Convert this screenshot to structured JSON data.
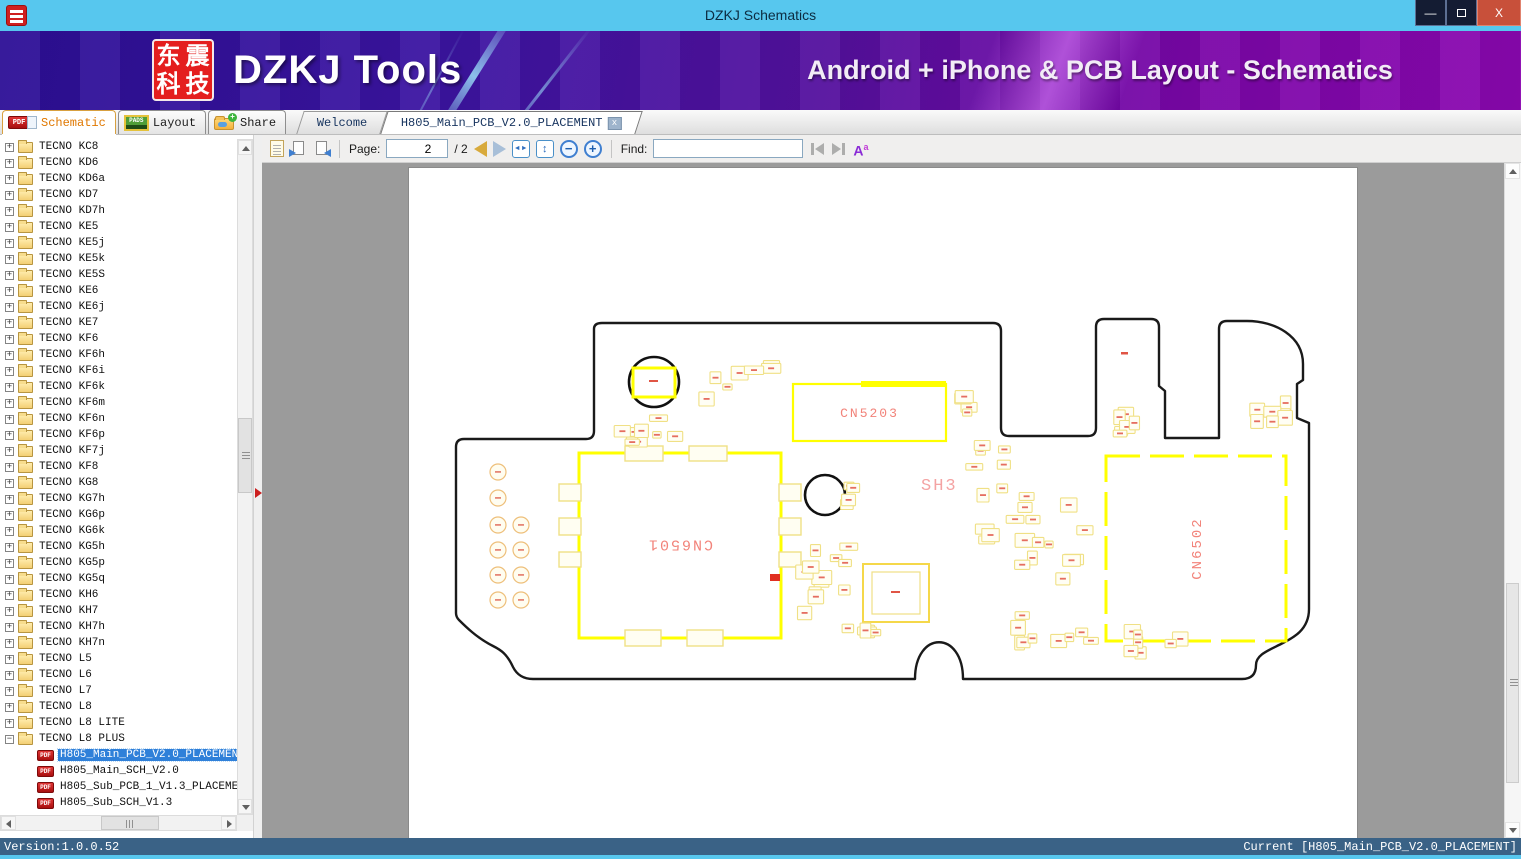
{
  "window": {
    "title": "DZKJ Schematics",
    "minimize_glyph": "—",
    "close_glyph": "X"
  },
  "banner": {
    "logo_chars": [
      "东",
      "震",
      "科",
      "技"
    ],
    "brand": "DZKJ Tools",
    "tagline": "Android + iPhone & PCB Layout - Schematics"
  },
  "app_tabs": [
    {
      "label": "Schematic",
      "icon": "pdf-icon",
      "active": true
    },
    {
      "label": "Layout",
      "icon": "pads-icon",
      "active": false
    },
    {
      "label": "Share",
      "icon": "share-folder-icon",
      "active": false
    }
  ],
  "doc_tabs": [
    {
      "label": "Welcome",
      "active": false,
      "closable": false
    },
    {
      "label": "H805_Main_PCB_V2.0_PLACEMENT",
      "active": true,
      "closable": true,
      "close_glyph": "x"
    }
  ],
  "pdf_badge_text": "PDF",
  "pads_badge_text": "PADS",
  "viewer_toolbar": {
    "page_label": "Page:",
    "page_current": "2",
    "page_total_text": "/ 2",
    "zoom_out_glyph": "−",
    "zoom_in_glyph": "+",
    "fit_width_glyph": "◄►",
    "fit_page_glyph": "↕",
    "find_label": "Find:",
    "find_value": "",
    "match_case_glyph": "A",
    "match_case_sup": "a"
  },
  "sidebar": {
    "folders": [
      "TECNO KC8",
      "TECNO KD6",
      "TECNO KD6a",
      "TECNO KD7",
      "TECNO KD7h",
      "TECNO KE5",
      "TECNO KE5j",
      "TECNO KE5k",
      "TECNO KE5S",
      "TECNO KE6",
      "TECNO KE6j",
      "TECNO KE7",
      "TECNO KF6",
      "TECNO KF6h",
      "TECNO KF6i",
      "TECNO KF6k",
      "TECNO KF6m",
      "TECNO KF6n",
      "TECNO KF6p",
      "TECNO KF7j",
      "TECNO KF8",
      "TECNO KG8",
      "TECNO KG7h",
      "TECNO KG6p",
      "TECNO KG6k",
      "TECNO KG5h",
      "TECNO KG5p",
      "TECNO KG5q",
      "TECNO KH6",
      "TECNO KH7",
      "TECNO KH7h",
      "TECNO KH7n",
      "TECNO L5",
      "TECNO L6",
      "TECNO L7",
      "TECNO L8",
      "TECNO L8 LITE",
      "TECNO L8 PLUS"
    ],
    "expanded": "TECNO L8 PLUS",
    "files": [
      {
        "label": "H805_Main_PCB_V2.0_PLACEMENT",
        "selected": true
      },
      {
        "label": "H805_Main_SCH_V2.0",
        "selected": false
      },
      {
        "label": "H805_Sub_PCB_1_V1.3_PLACEMENT",
        "selected": false
      },
      {
        "label": "H805_Sub_SCH_V1.3",
        "selected": false
      }
    ]
  },
  "pcb": {
    "components": [
      {
        "ref": "CN5203"
      },
      {
        "ref": "CN6501"
      },
      {
        "ref": "CN6502"
      }
    ],
    "region_label": "SH3"
  },
  "status": {
    "left": "Version:1.0.0.52",
    "right": "Current [H805_Main_PCB_V2.0_PLACEMENT]"
  },
  "colors": {
    "titlebar": "#57c7ee",
    "banner_purple": "#3c14a2",
    "board_outline": "#1a1a1a",
    "silk_yellow": "#ffff00",
    "silk_pale": "#f0e085",
    "label_pink": "#f2837a",
    "label_red": "#e05545",
    "selection_blue": "#2f80d9",
    "statusbar_blue": "#3a6286"
  }
}
